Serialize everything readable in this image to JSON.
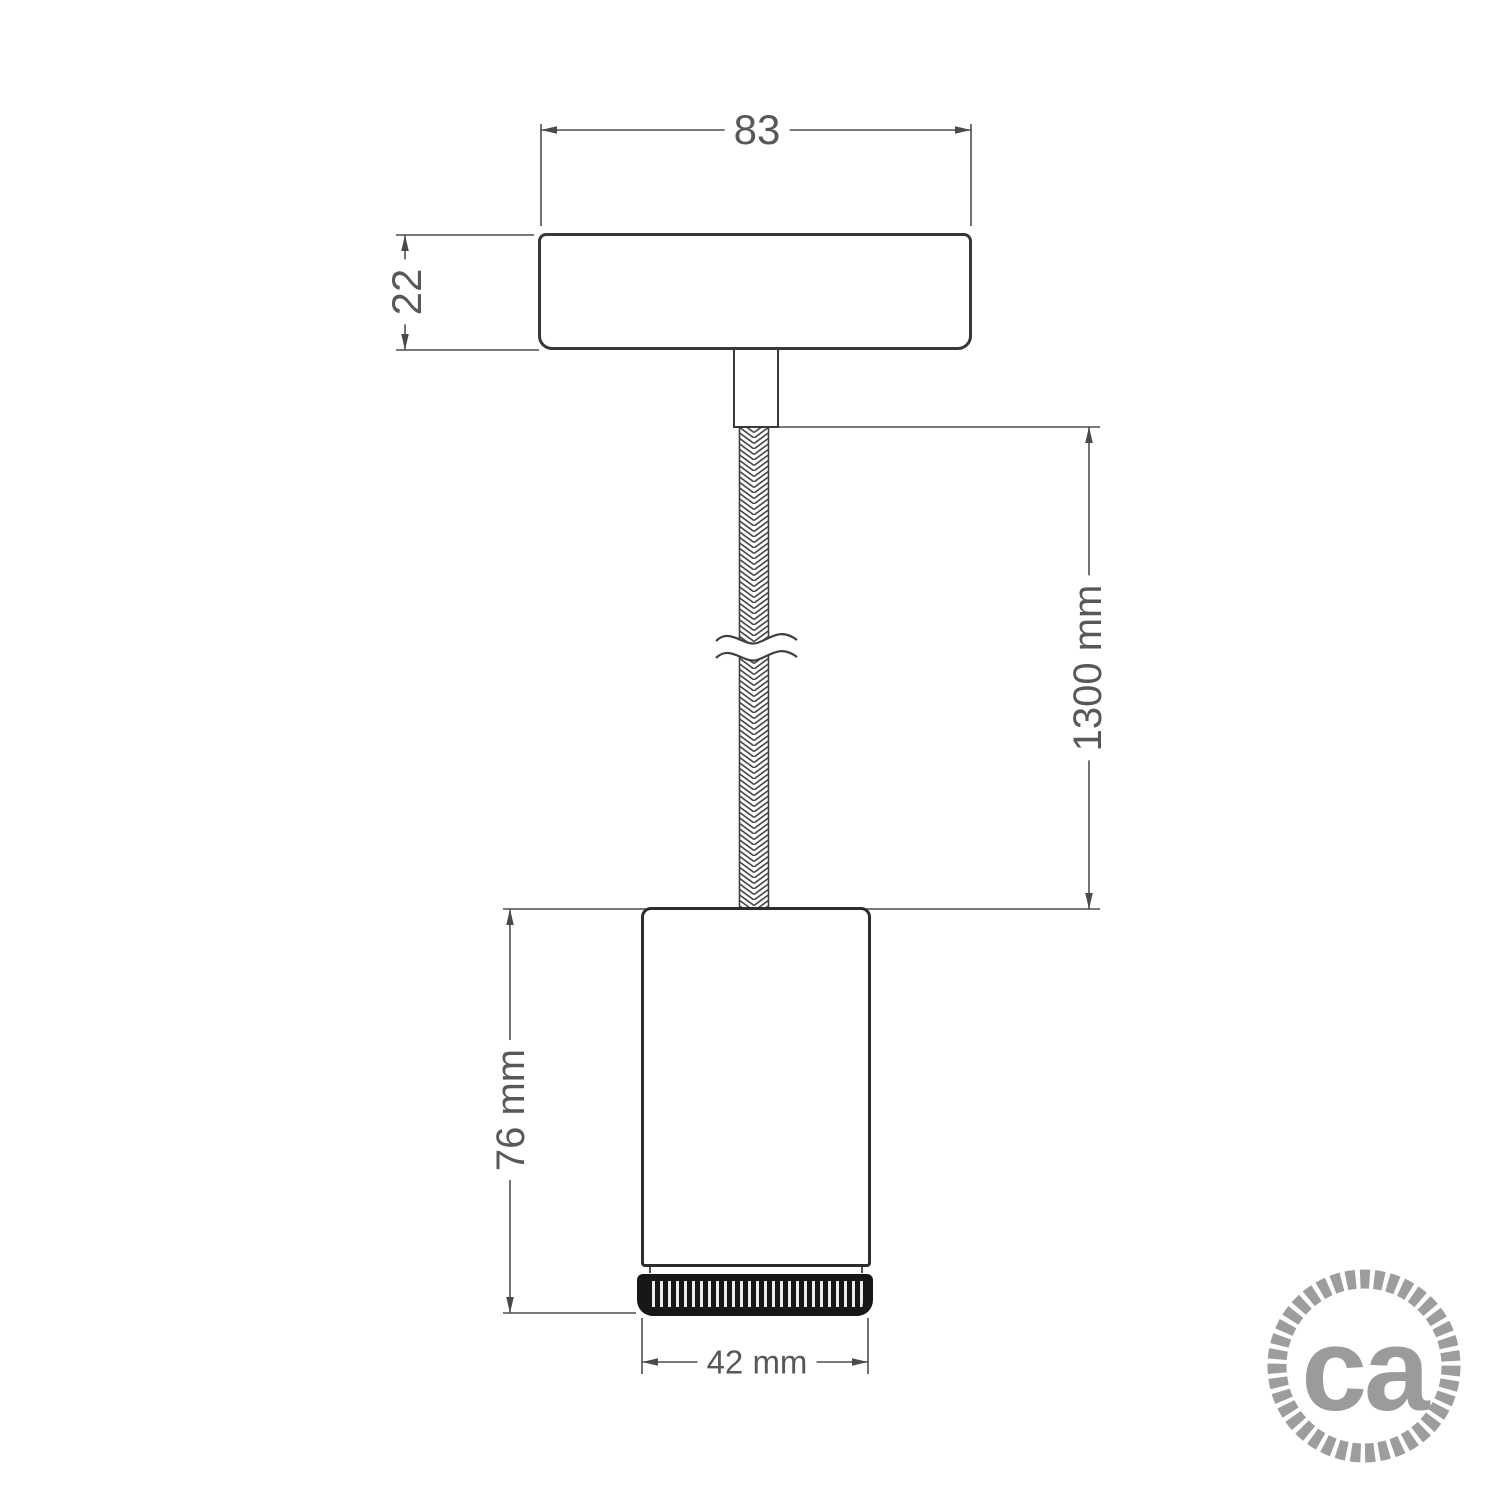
{
  "drawing": {
    "labels": {
      "canopy_width": "83",
      "canopy_height": "22",
      "cable_length": "1300 mm",
      "body_height": "76 mm",
      "body_diameter": "42 mm"
    },
    "logo": {
      "text": "ca"
    },
    "colors": {
      "outline": "#2d2d2d",
      "dimension_line": "#4f4f4f",
      "label_text": "#585858",
      "ring_fill": "#171717",
      "logo_gray": "#9b9b9b",
      "background": "#ffffff"
    }
  }
}
